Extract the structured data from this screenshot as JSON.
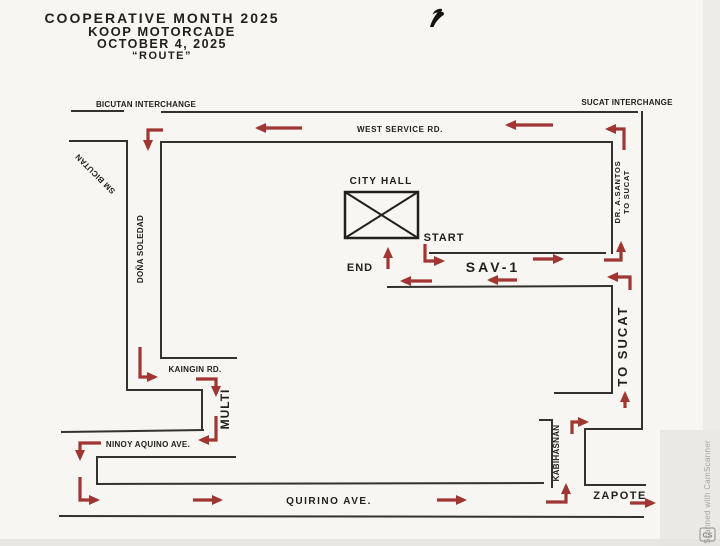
{
  "title": {
    "line1": "COOPERATIVE MONTH 2025",
    "line2": "KOOP MOTORCADE",
    "line3": "OCTOBER 4, 2025",
    "line4": "“ROUTE”"
  },
  "map": {
    "interchanges": {
      "bicutan": "BICUTAN INTERCHANGE",
      "sucat": "SUCAT INTERCHANGE"
    },
    "roads": {
      "west_service": "WEST SERVICE RD.",
      "sav1": "SAV-1",
      "kaingin": "KAINGIN RD.",
      "multi": "MULTI",
      "ninoy_aquino": "NINOY AQUINO AVE.",
      "quirino": "QUIRINO AVE.",
      "kabihasnan": "KABIHASNAN",
      "zapote": "ZAPOTE",
      "to_sucat": "TO SUCAT",
      "dr_a_santos_line1": "DR. A.SANTOS",
      "dr_a_santos_line2": "TO SUCAT",
      "dona_soledad": "DOÑA SOLEDAD",
      "sm_bicutan": "SM BICUTAN"
    },
    "landmarks": {
      "city_hall": "CITY HALL"
    },
    "route_markers": {
      "start": "START",
      "end": "END"
    }
  },
  "watermark": {
    "text": "Scanned with CamScanner",
    "badge": "CS"
  },
  "colors": {
    "route_arrow": "#a03531",
    "road_line": "#35312c",
    "paper": "#f7f6f3"
  }
}
